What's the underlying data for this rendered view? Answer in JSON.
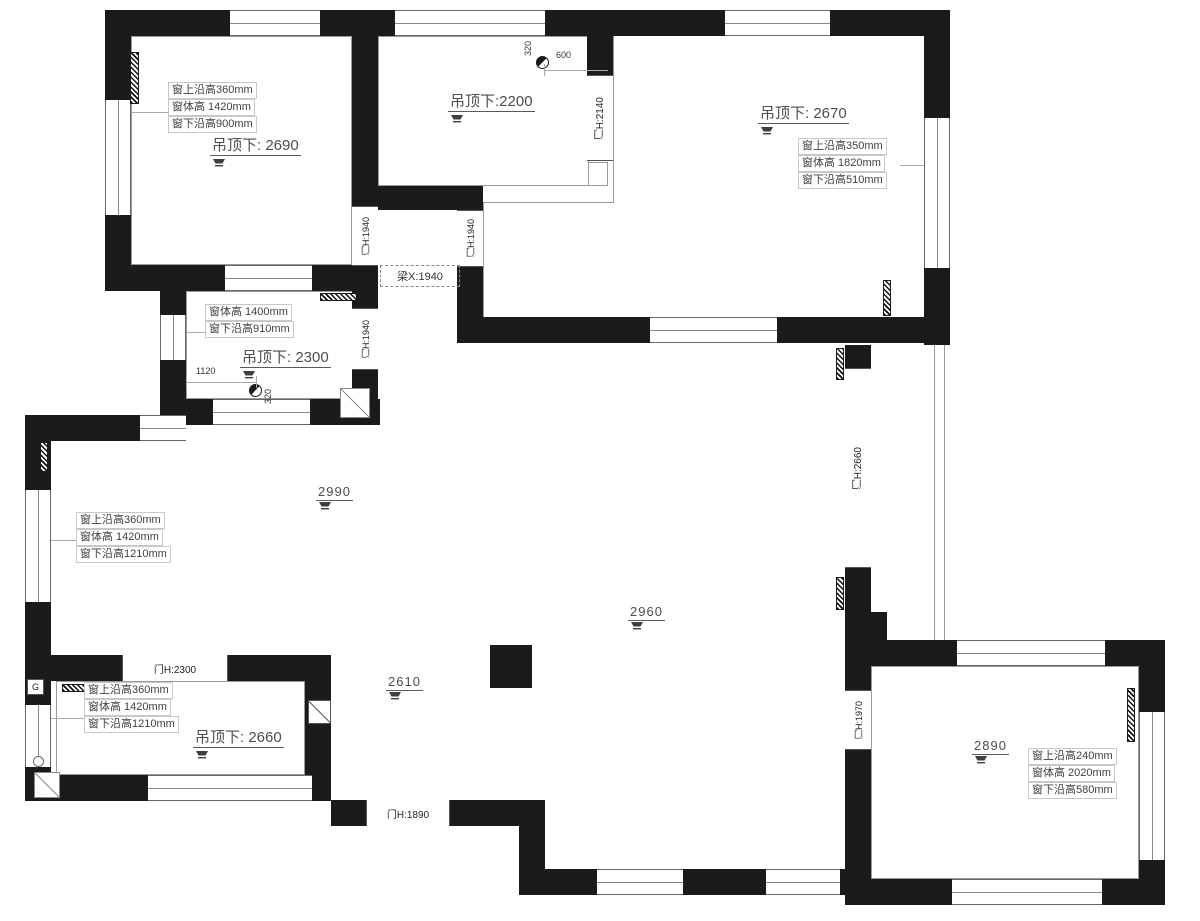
{
  "colors": {
    "wall": "#1b1b1b",
    "text": "#4d4d4d",
    "line": "#9a9a9a",
    "bg": "#ffffff"
  },
  "ceiling_labels": [
    "吊顶下: 2690",
    "吊顶下:2200",
    "吊顶下: 2670",
    "吊顶下: 2300",
    "吊顶下: 2660"
  ],
  "light_labels": [
    "2990",
    "2960",
    "2610",
    "2890"
  ],
  "beam_label": "梁X:1940",
  "door_labels": [
    "门H:2140",
    "门H:1940",
    "门H:1940",
    "门H:1940",
    "门H:2300",
    "门H:1890",
    "门H:2660",
    "门H:1970"
  ],
  "window_boxes": [
    {
      "lines": [
        "窗上沿高360mm",
        "窗体高 1420mm",
        "窗下沿高900mm"
      ]
    },
    {
      "lines": [
        "窗上沿高350mm",
        "窗体高 1820mm",
        "窗下沿高510mm"
      ]
    },
    {
      "lines": [
        "窗体高 1400mm",
        "窗下沿高910mm"
      ]
    },
    {
      "lines": [
        "窗上沿高360mm",
        "窗体高 1420mm",
        "窗下沿高1210mm"
      ]
    },
    {
      "lines": [
        "窗上沿高360mm",
        "窗体高 1420mm",
        "窗下沿高1210mm"
      ]
    },
    {
      "lines": [
        "窗上沿高240mm",
        "窗体高 2020mm",
        "窗下沿高580mm"
      ]
    }
  ],
  "dims": [
    "320",
    "600",
    "1120",
    "320"
  ],
  "markers": {
    "g": "G"
  }
}
